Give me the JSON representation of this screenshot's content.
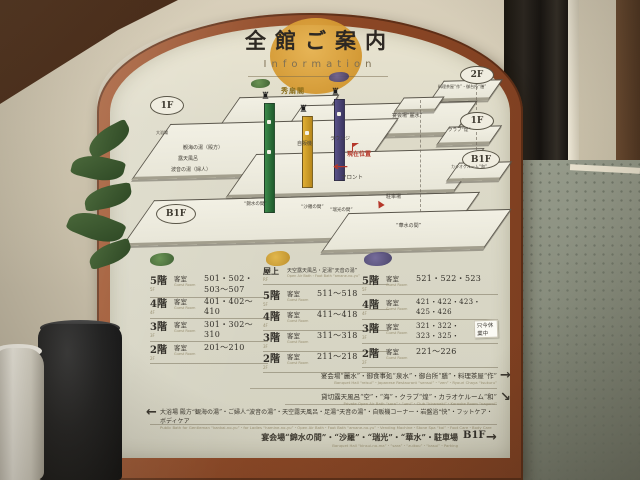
{
  "sign": {
    "title": "全館ご案内",
    "subtitle": "Information",
    "map": {
      "ovals": {
        "left_1f": "1F",
        "left_b1f": "B1F",
        "right_2f": "2F",
        "right_1f": "1F",
        "right_b1f": "B1F"
      },
      "gold_building": "秀扇閣",
      "current_location": "現在位置",
      "rooms": {
        "public_bath": "大浴場",
        "mens_bath": "観海の湯（殿方）",
        "open_air_bath": "露天風呂",
        "ladies_bath": "波音の湯（婦人）",
        "vending": "自販機",
        "lounge": "ラウンジ",
        "front_desk": "フロント",
        "banquet_reisui": "宴会場“麗水”",
        "kinsui": "“錦水の間”",
        "sara": "“沙羅の間”",
        "zuiko": "“瑞光の間”",
        "kasui": "“華水の間”",
        "parking": "駐車場",
        "chaya": "料理茶屋“作”・御台所“膳”",
        "club": "クラブ“煌”",
        "karaoke": "カラオケルーム“和”"
      }
    },
    "room_tables": [
      {
        "building_color": "#3f7a3c",
        "rows": [
          {
            "floor": "5階",
            "floor_en": "5F",
            "type": "客室",
            "type_en": "Guest Room",
            "rooms": "501・502・503〜507"
          },
          {
            "floor": "4階",
            "floor_en": "4F",
            "type": "客室",
            "type_en": "Guest Room",
            "rooms": "401・402〜410"
          },
          {
            "floor": "3階",
            "floor_en": "3F",
            "type": "客室",
            "type_en": "Guest Room",
            "rooms": "301・302〜310"
          },
          {
            "floor": "2階",
            "floor_en": "2F",
            "type": "客室",
            "type_en": "Guest Room",
            "rooms": "201〜210"
          }
        ]
      },
      {
        "building_color": "#c9992a",
        "building_name": "秀扇閣",
        "rows": [
          {
            "floor": "屋上",
            "floor_en": "RF",
            "type": "天空露天風呂・足湯“天音の湯”",
            "type_en": "Open Air Bath・Foot Bath “amane-no-yu”",
            "rooms": ""
          },
          {
            "floor": "5階",
            "floor_en": "5F",
            "type": "客室",
            "type_en": "Guest Room",
            "rooms": "511〜518"
          },
          {
            "floor": "4階",
            "floor_en": "4F",
            "type": "客室",
            "type_en": "Guest Room",
            "rooms": "411〜418"
          },
          {
            "floor": "3階",
            "floor_en": "3F",
            "type": "客室",
            "type_en": "Guest Room",
            "rooms": "311〜318"
          },
          {
            "floor": "2階",
            "floor_en": "2F",
            "type": "客室",
            "type_en": "Guest Room",
            "rooms": "211〜218"
          }
        ]
      },
      {
        "building_color": "#4f4878",
        "rows": [
          {
            "floor": "5階",
            "floor_en": "5F",
            "type": "客室",
            "type_en": "Guest Room",
            "rooms": "521・522・523"
          },
          {
            "floor": "4階",
            "floor_en": "4F",
            "type": "客室",
            "type_en": "Guest Room",
            "rooms": "421・422・423・425・426"
          },
          {
            "floor": "3階",
            "floor_en": "3F",
            "type": "客室",
            "type_en": "Guest Room",
            "rooms": "321・322・323・325・"
          },
          {
            "floor": "2階",
            "floor_en": "2F",
            "type": "客室",
            "type_en": "Guest Room",
            "rooms": "221〜226"
          }
        ]
      }
    ],
    "notice": "只今休業中",
    "facilities": [
      {
        "jp": "宴会場“麗水”・御食事処“泉水”・御台所“膳”・料理茶屋“作”",
        "en": "Banquet Hall “reisui”・Japanese Restaurant “sensui”・“zen”・Ryouri Chaya “tsukuru”",
        "arrow": "→"
      },
      {
        "jp": "貸切露天風呂“空”・“海”・クラブ“煌”・カラオケルーム“和”",
        "en": "Private Open Air Bath “sora”・“umi”・Club “kirameki”・Karaoke Room “nagomi”",
        "arrow": "↘"
      },
      {
        "jp": "大浴場 殿方“観海の湯”・ご婦人“波音の湯”・天空露天風呂・足湯“天音の湯”・自販機コーナー・岩盤浴“快”・フットケア・ボディケア",
        "en": "Public Bath for Gentleman “kankai-no-yu”・for Ladies “hamine-no-yu”・Open Air Bath・Foot Bath “amane-no-yu”・Vending Machine・Stone Spa “kai”・Foot Care・Body Care",
        "arrow": "←"
      },
      {
        "jp": "宴会場“錦水の間”・“沙羅”・“瑞光”・“華水”・駐車場",
        "en": "Banquet Hall “kinsui-no-ma”・“sara”・“zuikou”・“kasui”・Parking",
        "b1f": "B1F",
        "arrow": "→"
      }
    ]
  }
}
